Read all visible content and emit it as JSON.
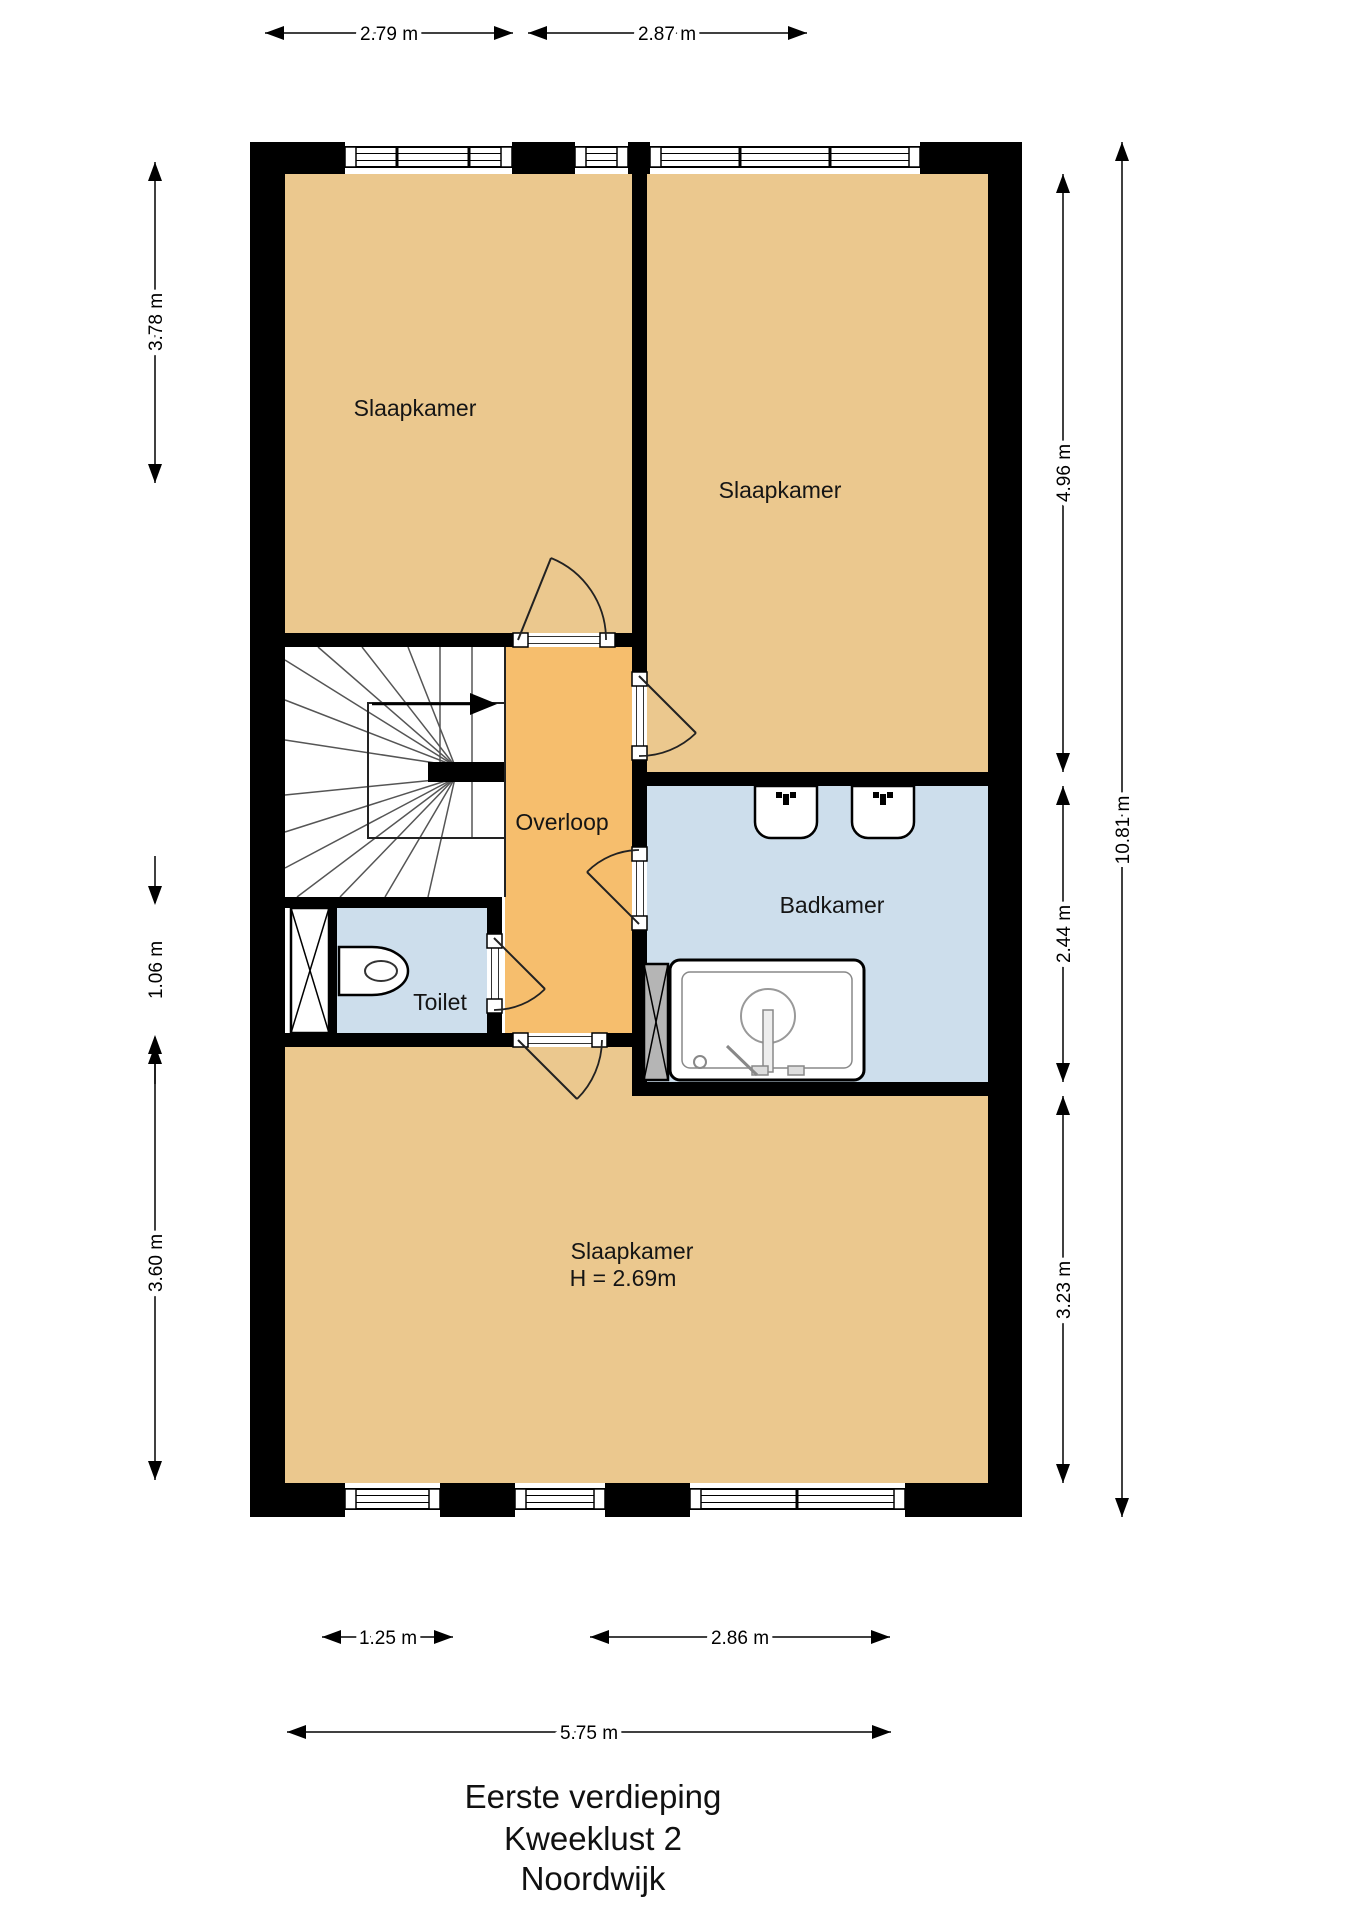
{
  "title": {
    "lines": [
      "Eerste verdieping",
      "Kweeklust 2",
      "Noordwijk"
    ]
  },
  "rooms": {
    "slaapkamer_top_left": {
      "label": "Slaapkamer"
    },
    "slaapkamer_top_right": {
      "label": "Slaapkamer"
    },
    "overloop": {
      "label": "Overloop"
    },
    "badkamer": {
      "label": "Badkamer"
    },
    "toilet": {
      "label": "Toilet"
    },
    "slaapkamer_bottom": {
      "label": "Slaapkamer",
      "height_note": "H = 2.69m"
    }
  },
  "dimensions": {
    "top": [
      {
        "label": "2.79 m"
      },
      {
        "label": "2.87 m"
      }
    ],
    "left": [
      {
        "label": "3.78 m"
      },
      {
        "label": "1.06 m"
      },
      {
        "label": "3.60 m"
      }
    ],
    "right": [
      {
        "label": "4.96 m"
      },
      {
        "label": "2.44 m"
      },
      {
        "label": "3.23 m"
      }
    ],
    "right_total": {
      "label": "10.81 m"
    },
    "bottom": [
      {
        "label": "1.25 m"
      },
      {
        "label": "2.86 m"
      }
    ],
    "bottom_total": {
      "label": "5.75 m"
    }
  },
  "fixtures": {
    "stairs": "stairs-icon",
    "stairs_direction": "stair-direction-arrow-icon",
    "toilet": "toilet-icon",
    "bathtub": "bathtub-icon",
    "sink_left": "sink-icon",
    "sink_right": "sink-icon",
    "duct_left": "duct-x-icon",
    "duct_bathroom": "duct-x-icon"
  },
  "colors": {
    "room_fill": "#EBC88E",
    "hall_fill": "#F6BE6D",
    "wet_fill": "#CDDEEC",
    "wall": "#000000",
    "background": "#FFFFFF"
  }
}
